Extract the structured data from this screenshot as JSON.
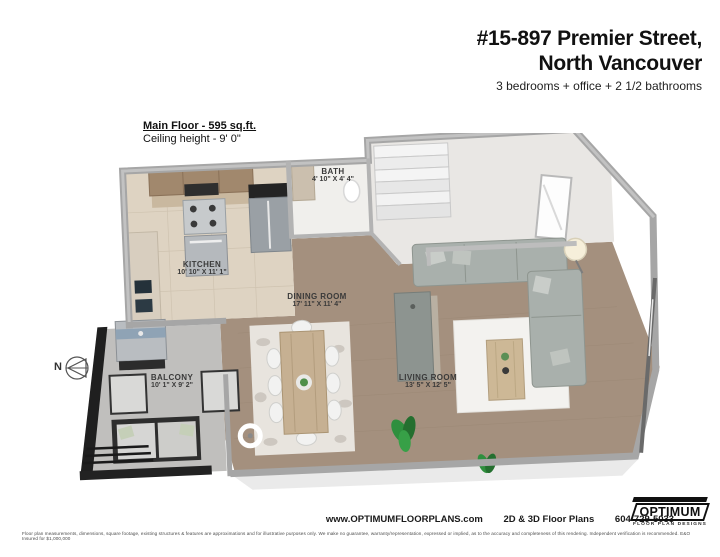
{
  "header": {
    "title_line1": "#15-897 Premier Street,",
    "title_line2": "North Vancouver",
    "subtitle": "3 bedrooms + office + 2 1/2 bathrooms"
  },
  "floor_info": {
    "floor_label": "Main Floor - 595 sq.ft.",
    "ceiling_height": "Ceiling height - 9' 0\""
  },
  "rooms": [
    {
      "name": "KITCHEN",
      "dims": "10' 10\" X 11' 1\""
    },
    {
      "name": "BATH",
      "dims": "4' 10\" X 4' 4\""
    },
    {
      "name": "DINING ROOM",
      "dims": "17' 11\" X 11' 4\""
    },
    {
      "name": "LIVING ROOM",
      "dims": "13' 5\" X 12' 5\""
    },
    {
      "name": "BALCONY",
      "dims": "10' 1\" X 9' 2\""
    }
  ],
  "compass": {
    "label": "N"
  },
  "footer": {
    "website": "www.OPTIMUMFLOORPLANS.com",
    "services": "2D & 3D Floor Plans",
    "phone": "604-729-5033",
    "disclaimer": "Floor plan measurements, dimensions, square footage, existing structures & features are approximations and for illustrative purposes only. We make no guarantee, warranty/representation, expressed or implied, as to the accuracy and completeness of this rendering. Independent verification is recommended. E&O Insured for $1,000,000",
    "logo_name": "OPTIMUM",
    "logo_tagline": "FLOOR PLAN DESIGNS"
  },
  "colors": {
    "wall_gray": "#a6a6a6",
    "wood_floor": "#a4907e",
    "kitchen_tile": "#ded3c2",
    "balcony_concrete": "#c0bfbd",
    "sofa_gray": "#a9b0ac",
    "railing_black": "#1f1f1f"
  }
}
